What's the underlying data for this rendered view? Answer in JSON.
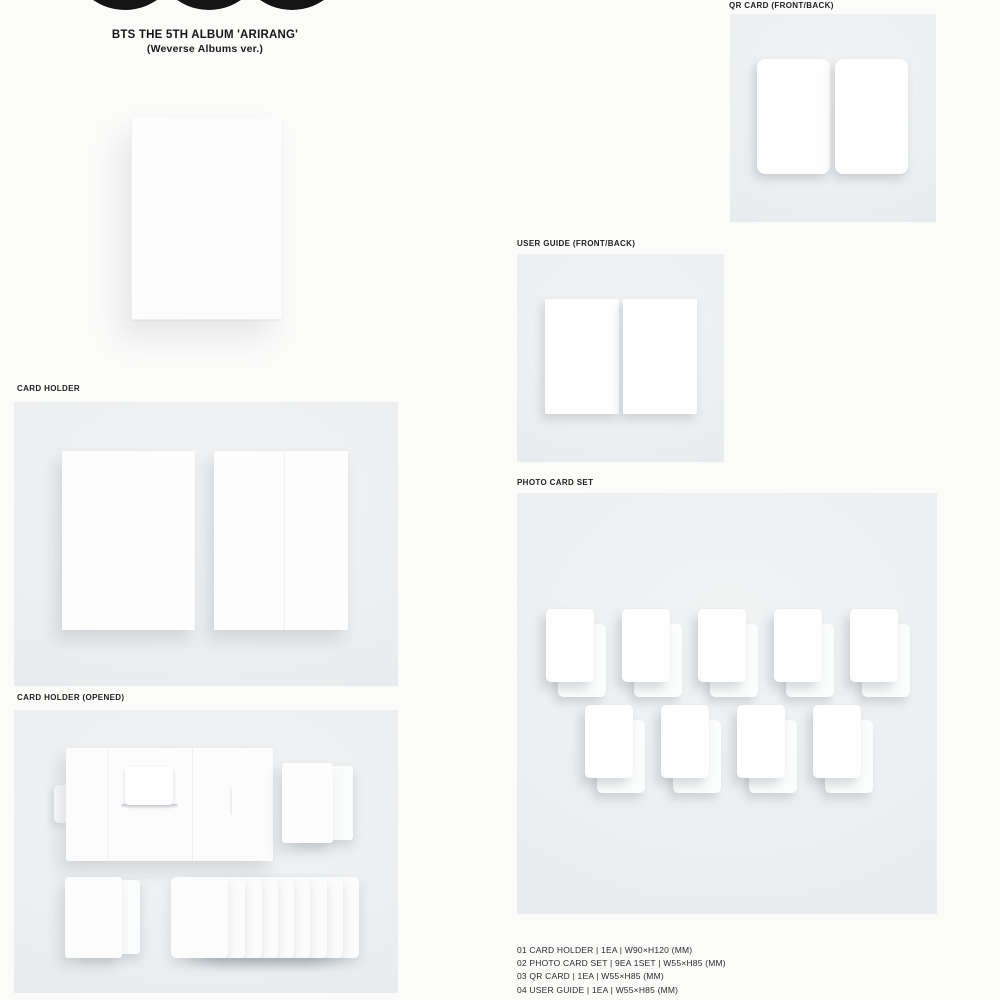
{
  "header": {
    "title": "BTS THE 5TH ALBUM 'ARIRANG'",
    "subtitle": "(Weverse Albums ver.)"
  },
  "logo": {
    "icon": "three-black-circles"
  },
  "sections": {
    "card_holder": {
      "label": "CARD HOLDER"
    },
    "card_holder_opened": {
      "label": "CARD HOLDER (OPENED)"
    },
    "qr_card": {
      "label": "QR CARD (FRONT/BACK)"
    },
    "user_guide": {
      "label": "USER GUIDE (FRONT/BACK)"
    },
    "photo_card_set": {
      "label": "PHOTO CARD SET",
      "row1_count": 5,
      "row2_count": 4,
      "total_cards": 9
    }
  },
  "spec_list": {
    "items": [
      "01  CARD HOLDER | 1EA | W90×H120 (MM)",
      "02  PHOTO CARD SET | 9EA 1SET | W55×H85 (MM)",
      "03  QR CARD | 1EA | W55×H85 (MM)",
      "04  USER GUIDE | 1EA | W55×H85 (MM)"
    ]
  },
  "colors": {
    "page_background": "#fbfbfa",
    "panel_background": "#eaedef",
    "card_white": "#fdfdfe",
    "logo_black": "#141414",
    "text": "#1b1b1b"
  }
}
